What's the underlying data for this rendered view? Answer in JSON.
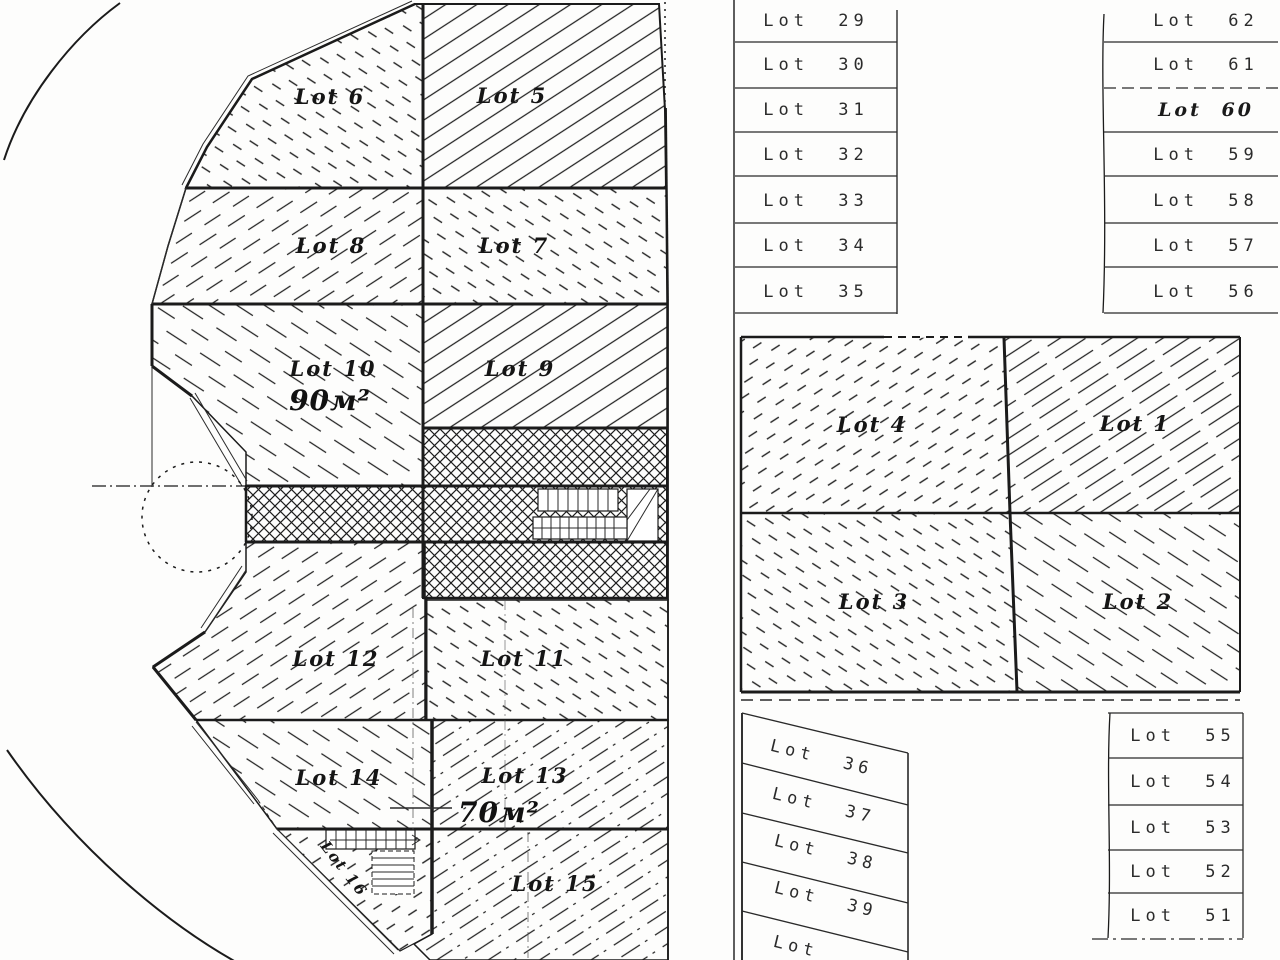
{
  "left_plan": {
    "lots": {
      "lot5": "Lot 5",
      "lot6": "Lot 6",
      "lot7": "Lot 7",
      "lot8": "Lot 8",
      "lot9": "Lot 9",
      "lot10": "Lot 10",
      "lot11": "Lot 11",
      "lot12": "Lot 12",
      "lot13": "Lot 13",
      "lot14": "Lot 14",
      "lot15": "Lot 15",
      "lot16": "Lot 16"
    },
    "areas": {
      "lot10": "90м²",
      "lot13": "70м²"
    }
  },
  "right_plan": {
    "block": {
      "lot1": "Lot 1",
      "lot2": "Lot 2",
      "lot3": "Lot 3",
      "lot4": "Lot 4"
    },
    "top_table": {
      "left_rows": [
        "Lot 29",
        "Lot 30",
        "Lot 31",
        "Lot 32",
        "Lot 33",
        "Lot 34",
        "Lot 35"
      ],
      "right_rows": [
        "Lot 62",
        "Lot 61",
        "Lot 60",
        "Lot 59",
        "Lot 58",
        "Lot 57",
        "Lot 56"
      ]
    },
    "bottom_table": {
      "left_rows": [
        "Lot 36",
        "Lot 37",
        "Lot 38",
        "Lot 39",
        "Lot"
      ],
      "right_rows": [
        "Lot 55",
        "Lot 54",
        "Lot 53",
        "Lot 52",
        "Lot 51"
      ]
    }
  },
  "colors": {
    "ink": "#1b1b1b",
    "paper": "#ffffff"
  }
}
